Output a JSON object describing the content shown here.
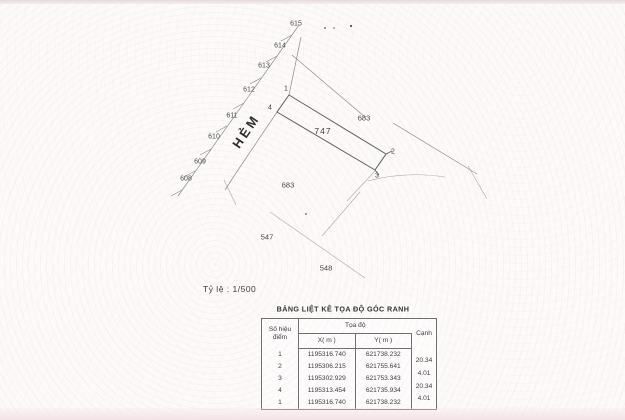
{
  "map": {
    "alley_label": "HẺM",
    "plot_number": "747",
    "parcels": {
      "p615": "615",
      "p614": "614",
      "p613": "613",
      "p612": "612",
      "p611": "611",
      "p610": "610",
      "p609": "609",
      "p608": "608"
    },
    "corners": {
      "c1": "1",
      "c2": "2",
      "c3": "3",
      "c4": "4"
    },
    "areas": {
      "right_683": "683",
      "bottom_683": "683",
      "n547": "547",
      "n548": "548"
    }
  },
  "scale_label": "Tỷ lệ : 1/500",
  "table": {
    "title": "BẢNG LIỆT KÊ TỌA ĐỘ GÓC RANH",
    "header": {
      "point_col_line1": "Số hiệu",
      "point_col_line2": "điểm",
      "coord_group": "Tọa độ",
      "x_col": "X( m )",
      "y_col": "Y( m )",
      "edge_col": "Cạnh"
    },
    "rows": [
      {
        "diem": "1",
        "x": "1195316.740",
        "y": "621738.232"
      },
      {
        "diem": "2",
        "x": "1195306.215",
        "y": "621755.641"
      },
      {
        "diem": "3",
        "x": "1195302.929",
        "y": "621753.343"
      },
      {
        "diem": "4",
        "x": "1195313.454",
        "y": "621735.934"
      },
      {
        "diem": "1",
        "x": "1195316.740",
        "y": "621738.232"
      }
    ],
    "edge_values": [
      "20.34",
      "4.01",
      "20.34",
      "4.01"
    ]
  }
}
